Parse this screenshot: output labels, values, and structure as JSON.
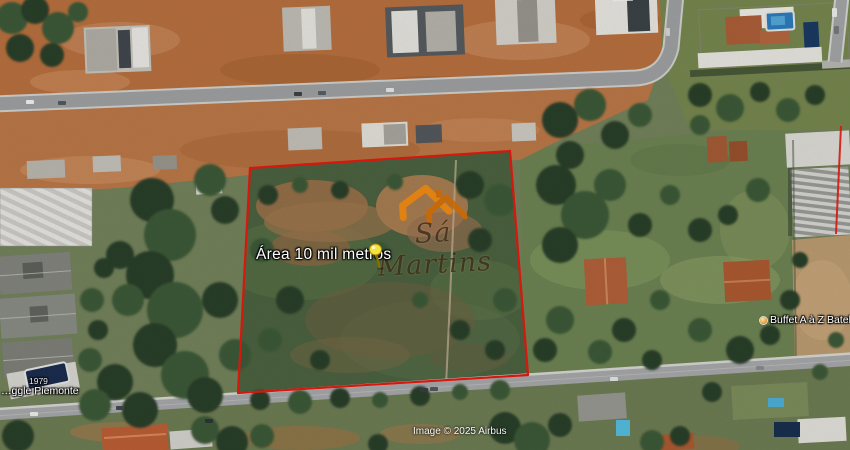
{
  "map": {
    "view_type": "satellite imagery",
    "attribution": "Image © 2025 Airbus",
    "annotation": {
      "label": "Área 10 mil metros",
      "polygon_points": "250,168 510,151 528,375 238,393",
      "outline_color": "#e8190f",
      "pin_color": "#f4e33c"
    },
    "watermark": {
      "name": "Sá Martins",
      "accent_color": "#e07f10"
    },
    "pois": [
      {
        "id": "piemonte",
        "lines": [
          "1979",
          "…ggle Piemonte"
        ]
      },
      {
        "id": "buffet",
        "label": "Buffet A à Z Batel"
      }
    ]
  }
}
